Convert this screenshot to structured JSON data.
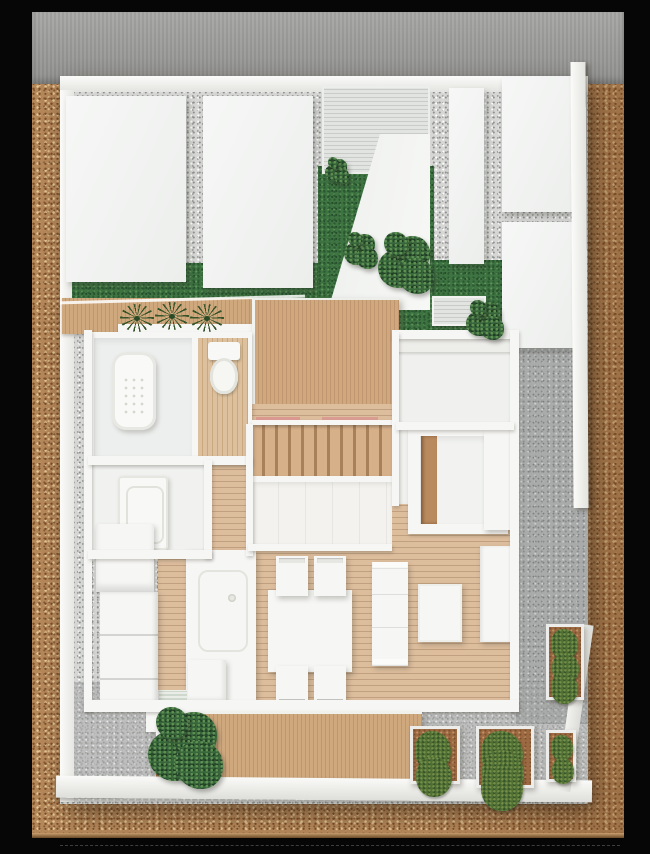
{
  "scene": {
    "type": "photograph",
    "subject": "top-down architectural scale model of a one-storey house interior",
    "setting": "model pinned on a cork board with a grey wall strip at top",
    "view": "plan view from directly above"
  },
  "palette": {
    "frame_black": "#060606",
    "wall_gray": "#9c9c9a",
    "wall_gray_dark": "#86868a",
    "cork": "#b5885a",
    "cork_speck_light": "#e3c697",
    "cork_speck_dark": "#7c4e28",
    "gravel": "#d6d7d5",
    "gravel_dark": "#a9abaa",
    "gravel_speck": "#8f918f",
    "white": "#f6f6f4",
    "grass": "#3e7342",
    "grass_dark": "#2d5a33",
    "grass_light": "#5d9458",
    "wood": "#d8b48d",
    "wood_dark": "#c09671",
    "wood_deck": "#cfa87e",
    "soil": "#9c6a42",
    "bush": "#516f33",
    "bush_dark": "#35542a",
    "tree": "#39673c",
    "tree_dark": "#27492b",
    "tree_light": "#5f9153",
    "handrail_pink": "#d98f8f"
  },
  "neighbor_panels": [
    {
      "x": 66,
      "y": 96,
      "w": 120,
      "h": 186
    },
    {
      "x": 203,
      "y": 96,
      "w": 110,
      "h": 192
    },
    {
      "x": 449,
      "y": 88,
      "w": 35,
      "h": 176
    },
    {
      "x": 502,
      "y": 76,
      "w": 76,
      "h": 136
    },
    {
      "x": 502,
      "y": 222,
      "w": 76,
      "h": 126
    }
  ],
  "green_patches": [
    {
      "x": 72,
      "y": 263,
      "w": 258,
      "h": 41
    },
    {
      "x": 318,
      "y": 166,
      "w": 116,
      "h": 178
    },
    {
      "x": 427,
      "y": 260,
      "w": 80,
      "h": 86
    }
  ],
  "trees": [
    {
      "cx": 338,
      "cy": 172,
      "r": 13
    },
    {
      "cx": 362,
      "cy": 252,
      "r": 18
    },
    {
      "cx": 408,
      "cy": 266,
      "r": 30
    },
    {
      "cx": 486,
      "cy": 322,
      "r": 20
    },
    {
      "cx": 188,
      "cy": 752,
      "r": 40
    }
  ],
  "deck_plants": [
    {
      "cx": 137,
      "cy": 318
    },
    {
      "cx": 172,
      "cy": 316
    },
    {
      "cx": 207,
      "cy": 318
    }
  ],
  "planters": [
    {
      "x": 546,
      "y": 624,
      "w": 38,
      "h": 76,
      "bushes": 3
    },
    {
      "x": 410,
      "y": 726,
      "w": 50,
      "h": 58,
      "bushes": 2
    },
    {
      "x": 476,
      "y": 726,
      "w": 58,
      "h": 62,
      "bushes": 3
    },
    {
      "x": 546,
      "y": 730,
      "w": 30,
      "h": 52,
      "bushes": 2
    }
  ],
  "furniture": [
    {
      "kind": "dining-table",
      "x": 268,
      "y": 590,
      "w": 84,
      "h": 82
    },
    {
      "kind": "dining-chair-n",
      "x": 276,
      "y": 556,
      "w": 32,
      "h": 40
    },
    {
      "kind": "dining-chair-n",
      "x": 314,
      "y": 556,
      "w": 32,
      "h": 40
    },
    {
      "kind": "dining-chair-s",
      "x": 276,
      "y": 666,
      "w": 32,
      "h": 40
    },
    {
      "kind": "dining-chair-s",
      "x": 314,
      "y": 666,
      "w": 32,
      "h": 40
    },
    {
      "kind": "sofa",
      "x": 372,
      "y": 562,
      "w": 36,
      "h": 104
    },
    {
      "kind": "coffee-table",
      "x": 418,
      "y": 584,
      "w": 44,
      "h": 58
    },
    {
      "kind": "media-cabinet",
      "x": 480,
      "y": 546,
      "w": 34,
      "h": 96
    },
    {
      "kind": "kitchen-cabinet",
      "x": 96,
      "y": 524,
      "w": 58,
      "h": 68
    },
    {
      "kind": "shelf-unit",
      "x": 100,
      "y": 592,
      "w": 58,
      "h": 110
    },
    {
      "kind": "porch-step",
      "x": 146,
      "y": 708,
      "w": 46,
      "h": 24
    },
    {
      "kind": "porch-step",
      "x": 156,
      "y": 726,
      "w": 46,
      "h": 24
    }
  ]
}
